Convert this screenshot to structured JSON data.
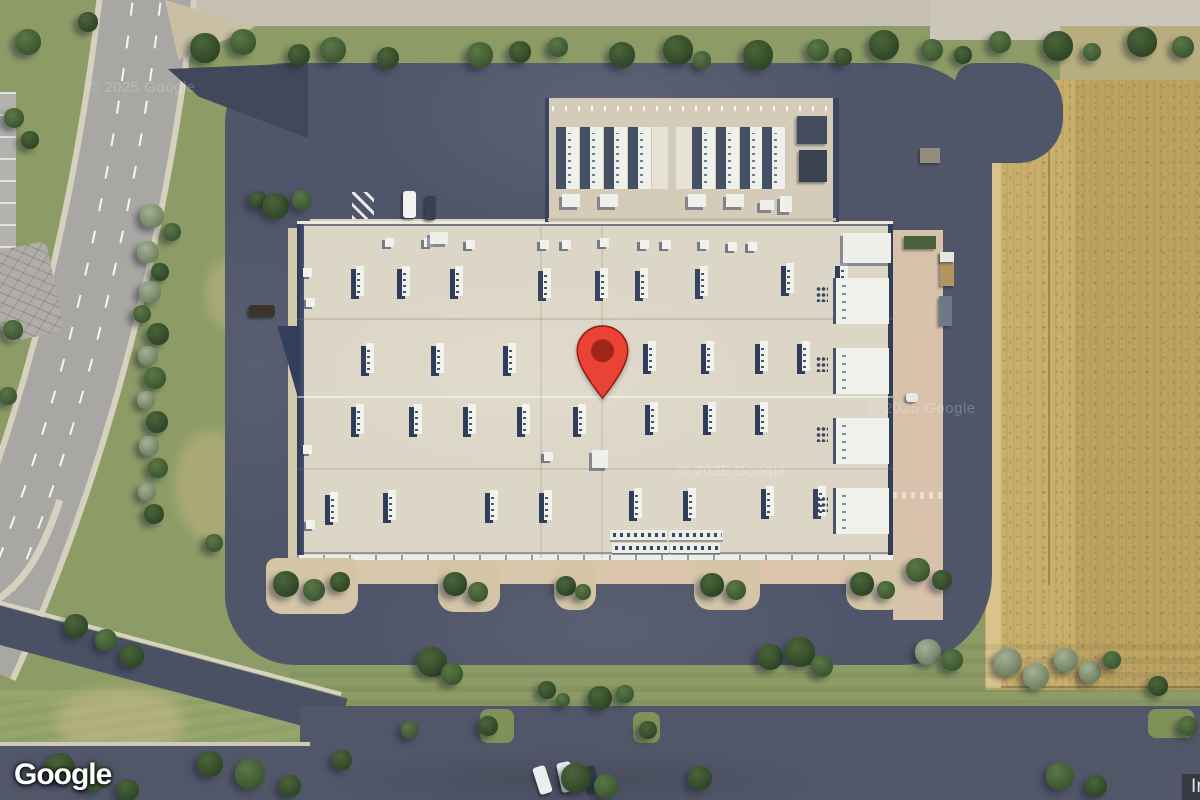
{
  "map": {
    "logo_text": "Google",
    "attribution": "Imagery ©2025 Airbus, Maxar Technologies",
    "watermark": "© 2025 Google",
    "pin": {
      "name": "red-map-pin",
      "color": "#EA4335",
      "inner_color": "#A0261A",
      "outline": "#8E1D12"
    }
  },
  "palette": {
    "grass": "#8d9c66",
    "field": "#c9ae6c",
    "asphalt": "#505669",
    "roof": "#dcd6c6",
    "navy_shadow": "#33405c",
    "road_gray": "#a8a7a4",
    "attrib_bg": "rgba(32,32,32,0.55)",
    "logo_color": "#ffffff"
  },
  "scene": {
    "tree_shades": [
      [
        "#4a6539",
        "#2f4527"
      ],
      [
        "#5b7845",
        "#3a5530"
      ],
      [
        "#a3b194",
        "#707f61"
      ]
    ],
    "trees": [
      [
        205,
        48,
        15,
        0
      ],
      [
        243,
        42,
        13,
        1
      ],
      [
        299,
        55,
        11,
        0
      ],
      [
        333,
        50,
        13,
        1
      ],
      [
        388,
        58,
        11,
        0
      ],
      [
        480,
        55,
        13,
        1
      ],
      [
        520,
        52,
        11,
        0
      ],
      [
        558,
        47,
        10,
        1
      ],
      [
        622,
        55,
        13,
        0
      ],
      [
        678,
        50,
        15,
        0
      ],
      [
        702,
        60,
        9,
        1
      ],
      [
        758,
        55,
        15,
        0
      ],
      [
        818,
        50,
        11,
        1
      ],
      [
        843,
        57,
        9,
        0
      ],
      [
        884,
        45,
        15,
        0
      ],
      [
        932,
        50,
        11,
        1
      ],
      [
        963,
        55,
        9,
        0
      ],
      [
        1000,
        42,
        11,
        1
      ],
      [
        1058,
        46,
        15,
        0
      ],
      [
        1092,
        52,
        9,
        1
      ],
      [
        1142,
        42,
        15,
        0
      ],
      [
        1183,
        47,
        11,
        1
      ],
      [
        28,
        42,
        13,
        1
      ],
      [
        88,
        22,
        10,
        0
      ],
      [
        14,
        118,
        10,
        1
      ],
      [
        30,
        140,
        9,
        0
      ],
      [
        152,
        216,
        12,
        2
      ],
      [
        172,
        232,
        9,
        1
      ],
      [
        148,
        252,
        11,
        2
      ],
      [
        160,
        272,
        9,
        0
      ],
      [
        150,
        292,
        11,
        2
      ],
      [
        142,
        314,
        9,
        1
      ],
      [
        158,
        334,
        11,
        0
      ],
      [
        148,
        356,
        10,
        2
      ],
      [
        155,
        378,
        11,
        1
      ],
      [
        146,
        400,
        9,
        2
      ],
      [
        157,
        422,
        11,
        0
      ],
      [
        149,
        446,
        10,
        2
      ],
      [
        158,
        468,
        10,
        1
      ],
      [
        147,
        492,
        9,
        2
      ],
      [
        154,
        514,
        10,
        0
      ],
      [
        214,
        543,
        9,
        1
      ],
      [
        13,
        330,
        10,
        1
      ],
      [
        8,
        396,
        9,
        1
      ],
      [
        258,
        200,
        9,
        0
      ],
      [
        276,
        206,
        13,
        0
      ],
      [
        302,
        200,
        10,
        1
      ],
      [
        286,
        584,
        13,
        0
      ],
      [
        314,
        590,
        11,
        1
      ],
      [
        340,
        582,
        10,
        0
      ],
      [
        455,
        584,
        12,
        0
      ],
      [
        478,
        592,
        10,
        1
      ],
      [
        566,
        586,
        10,
        0
      ],
      [
        583,
        592,
        8,
        1
      ],
      [
        712,
        585,
        12,
        0
      ],
      [
        736,
        590,
        10,
        1
      ],
      [
        862,
        584,
        12,
        0
      ],
      [
        886,
        590,
        9,
        1
      ],
      [
        918,
        570,
        12,
        1
      ],
      [
        942,
        580,
        10,
        0
      ],
      [
        432,
        662,
        15,
        0
      ],
      [
        452,
        674,
        11,
        1
      ],
      [
        547,
        690,
        9,
        0
      ],
      [
        563,
        700,
        7,
        1
      ],
      [
        600,
        698,
        12,
        0
      ],
      [
        625,
        694,
        9,
        1
      ],
      [
        770,
        657,
        13,
        0
      ],
      [
        800,
        652,
        15,
        0
      ],
      [
        822,
        666,
        11,
        1
      ],
      [
        928,
        652,
        13,
        2
      ],
      [
        952,
        660,
        11,
        1
      ],
      [
        1008,
        662,
        14,
        2
      ],
      [
        1036,
        676,
        13,
        2
      ],
      [
        1066,
        660,
        12,
        2
      ],
      [
        1090,
        672,
        11,
        2
      ],
      [
        1112,
        660,
        9,
        1
      ],
      [
        1158,
        686,
        10,
        0
      ],
      [
        76,
        626,
        12,
        0
      ],
      [
        106,
        640,
        11,
        1
      ],
      [
        132,
        656,
        12,
        0
      ],
      [
        60,
        768,
        15,
        0
      ],
      [
        94,
        778,
        13,
        1
      ],
      [
        128,
        790,
        11,
        0
      ],
      [
        210,
        764,
        13,
        0
      ],
      [
        250,
        774,
        15,
        1
      ],
      [
        290,
        786,
        11,
        0
      ],
      [
        342,
        760,
        10,
        0
      ],
      [
        410,
        730,
        9,
        1
      ],
      [
        488,
        726,
        10,
        0
      ],
      [
        576,
        778,
        15,
        0
      ],
      [
        606,
        786,
        12,
        1
      ],
      [
        648,
        730,
        9,
        0
      ],
      [
        700,
        778,
        12,
        0
      ],
      [
        1060,
        776,
        14,
        1
      ],
      [
        1096,
        786,
        11,
        0
      ],
      [
        1188,
        726,
        10,
        1
      ]
    ],
    "hvac": [
      [
        356,
        266,
        3
      ],
      [
        402,
        266,
        4
      ],
      [
        455,
        266,
        4
      ],
      [
        543,
        268,
        2
      ],
      [
        600,
        268,
        2
      ],
      [
        640,
        268,
        2
      ],
      [
        700,
        266,
        2
      ],
      [
        786,
        263,
        4
      ],
      [
        840,
        263,
        3
      ],
      [
        366,
        343,
        5
      ],
      [
        436,
        343,
        5
      ],
      [
        508,
        343,
        4
      ],
      [
        648,
        341,
        4
      ],
      [
        706,
        341,
        4
      ],
      [
        760,
        341,
        3
      ],
      [
        802,
        341,
        3
      ],
      [
        356,
        404,
        4
      ],
      [
        414,
        404,
        4
      ],
      [
        468,
        404,
        4
      ],
      [
        522,
        404,
        4
      ],
      [
        578,
        404,
        4
      ],
      [
        650,
        402,
        5
      ],
      [
        708,
        402,
        4
      ],
      [
        760,
        402,
        4
      ],
      [
        330,
        492,
        3
      ],
      [
        388,
        490,
        4
      ],
      [
        490,
        490,
        3
      ],
      [
        544,
        490,
        3
      ],
      [
        634,
        488,
        3
      ],
      [
        688,
        488,
        3
      ],
      [
        766,
        486,
        4
      ],
      [
        818,
        486,
        2
      ]
    ],
    "vents": [
      [
        385,
        238
      ],
      [
        424,
        238
      ],
      [
        466,
        240
      ],
      [
        540,
        240
      ],
      [
        562,
        240
      ],
      [
        600,
        238
      ],
      [
        640,
        240
      ],
      [
        662,
        240
      ],
      [
        700,
        240
      ],
      [
        728,
        242
      ],
      [
        748,
        242
      ],
      [
        303,
        268
      ],
      [
        306,
        298
      ],
      [
        303,
        445
      ],
      [
        306,
        520
      ],
      [
        544,
        452
      ]
    ],
    "roof_squares": [
      [
        843,
        233,
        48,
        30
      ],
      [
        592,
        450,
        16,
        18
      ],
      [
        430,
        232,
        18,
        12
      ]
    ],
    "bays_right": [
      [
        833,
        278
      ],
      [
        833,
        348
      ],
      [
        833,
        418
      ],
      [
        833,
        488
      ]
    ],
    "gen_bays": [
      [
        556,
        0
      ],
      [
        580,
        0
      ],
      [
        604,
        0
      ],
      [
        628,
        0
      ],
      [
        652,
        1
      ],
      [
        676,
        1
      ],
      [
        692,
        0
      ],
      [
        716,
        0
      ],
      [
        740,
        0
      ],
      [
        762,
        0
      ]
    ],
    "gen_small": [
      [
        562,
        194,
        18,
        13
      ],
      [
        600,
        194,
        18,
        13
      ],
      [
        688,
        194,
        18,
        13
      ],
      [
        726,
        194,
        18,
        13
      ],
      [
        760,
        200,
        14,
        10
      ],
      [
        780,
        196,
        12,
        16
      ]
    ],
    "cool_bars": [
      [
        610,
        530,
        57
      ],
      [
        669,
        530,
        54
      ],
      [
        612,
        543,
        57
      ],
      [
        670,
        543,
        50
      ]
    ],
    "stalls": [
      {
        "x": 310,
        "y": 191,
        "w": 232,
        "h": 29,
        "d": "v",
        "g": 16
      },
      {
        "x": 243,
        "y": 212,
        "w": 50,
        "h": 366,
        "d": "h",
        "g": 20
      },
      {
        "x": 360,
        "y": 583,
        "w": 80,
        "h": 33,
        "d": "v",
        "g": 16
      },
      {
        "x": 500,
        "y": 583,
        "w": 56,
        "h": 33,
        "d": "v",
        "g": 16
      },
      {
        "x": 597,
        "y": 583,
        "w": 97,
        "h": 33,
        "d": "v",
        "g": 16
      },
      {
        "x": 762,
        "y": 583,
        "w": 84,
        "h": 33,
        "d": "v",
        "g": 16
      },
      {
        "x": 905,
        "y": 583,
        "w": 36,
        "h": 33,
        "d": "v",
        "g": 16
      },
      {
        "x": 313,
        "y": 711,
        "w": 167,
        "h": 31,
        "d": "v",
        "g": 17
      },
      {
        "x": 512,
        "y": 711,
        "w": 123,
        "h": 31,
        "d": "v",
        "g": 17
      },
      {
        "x": 660,
        "y": 711,
        "w": 488,
        "h": 31,
        "d": "v",
        "g": 17
      },
      {
        "x": 28,
        "y": 786,
        "w": 118,
        "h": 14,
        "d": "v",
        "g": 18
      }
    ],
    "islands_tan": [
      [
        266,
        558,
        92,
        56
      ],
      [
        438,
        560,
        62,
        52
      ],
      [
        554,
        560,
        42,
        50
      ],
      [
        694,
        560,
        66,
        50
      ],
      [
        846,
        560,
        59,
        50
      ]
    ],
    "islands_grass": [
      [
        480,
        709,
        34,
        34
      ],
      [
        633,
        712,
        27,
        31
      ],
      [
        1148,
        709,
        46,
        29
      ]
    ],
    "cars": [
      [
        403,
        191,
        13,
        27,
        "#f2f2ef",
        0
      ],
      [
        425,
        196,
        11,
        24,
        "#39414f",
        0
      ],
      [
        249,
        305,
        26,
        12,
        "#3a342b",
        0
      ],
      [
        906,
        393,
        12,
        9,
        "#e8e8e6",
        0
      ],
      [
        536,
        766,
        13,
        28,
        "#eceff0",
        -18
      ],
      [
        559,
        762,
        14,
        30,
        "#e8ebec",
        -12
      ],
      [
        586,
        766,
        11,
        26,
        "#2f3844",
        -10
      ]
    ],
    "objects": [
      [
        904,
        236,
        32,
        13,
        "#49603f"
      ],
      [
        940,
        252,
        14,
        34,
        "#b3935f"
      ],
      [
        940,
        252,
        14,
        10,
        "#e9e6df"
      ],
      [
        939,
        296,
        13,
        30,
        "#6f7985"
      ],
      [
        920,
        148,
        20,
        15,
        "#948d7e"
      ],
      [
        797,
        116,
        30,
        28,
        "#434c5c"
      ],
      [
        799,
        150,
        28,
        32,
        "#3a4250"
      ]
    ],
    "watermarks": [
      [
        88,
        79,
        0.2
      ],
      [
        678,
        463,
        0.26
      ],
      [
        868,
        400,
        0.22
      ]
    ]
  }
}
